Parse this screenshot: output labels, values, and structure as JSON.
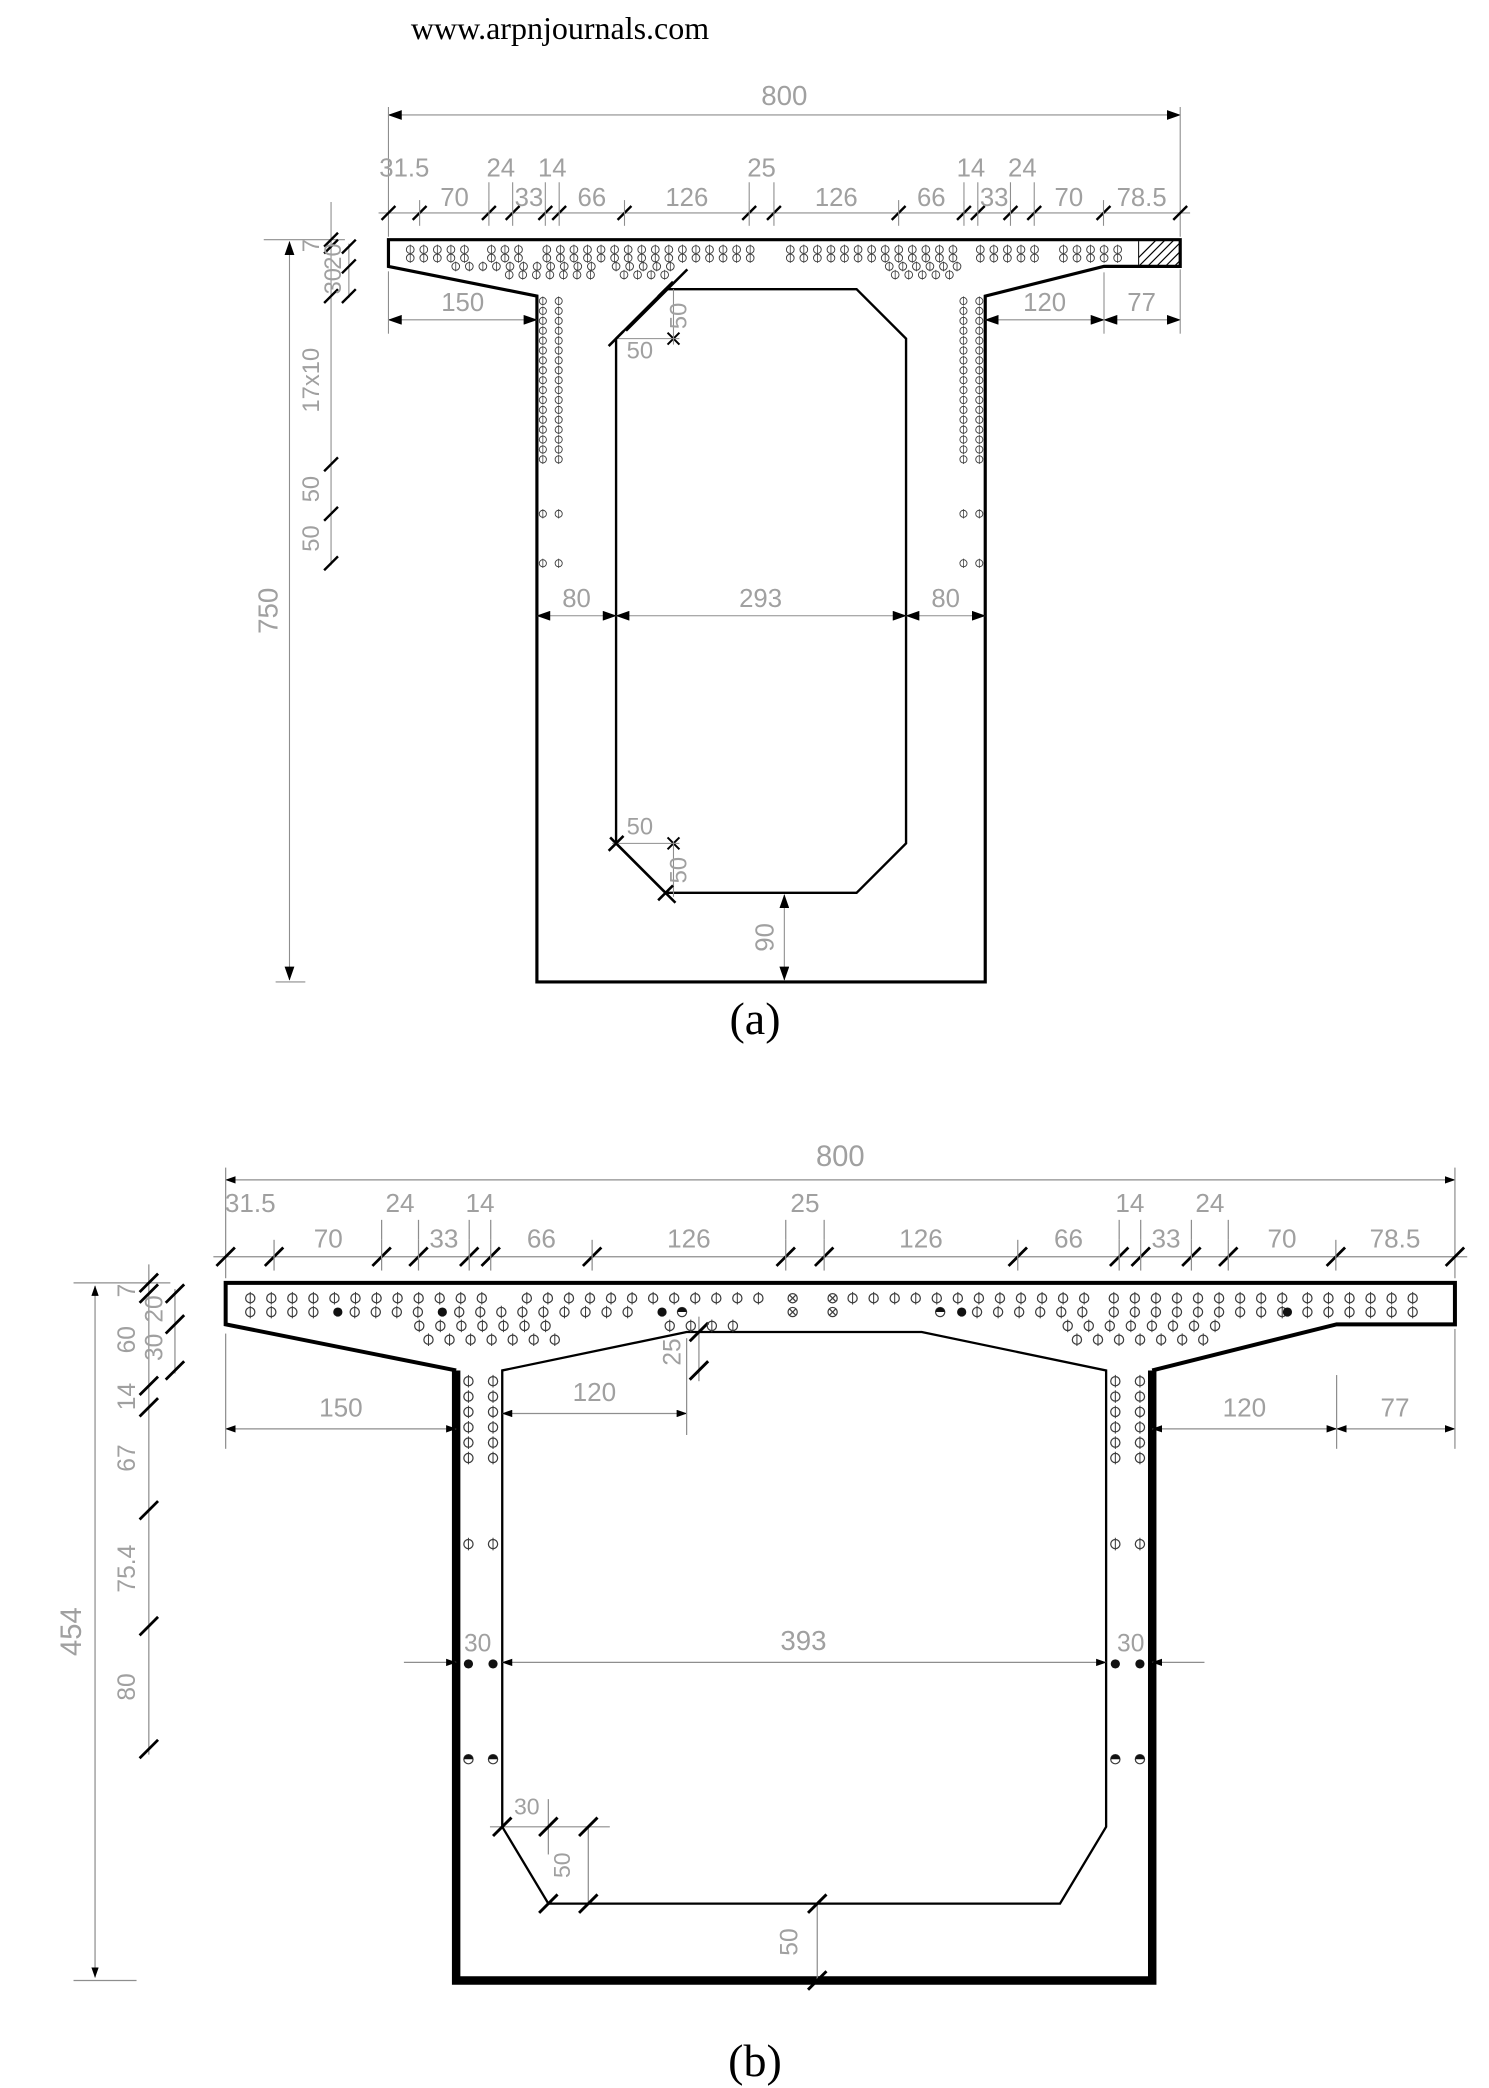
{
  "page": {
    "title": "www.arpnjournals.com"
  },
  "figure_a": {
    "caption": "(a)",
    "overall_width": "800",
    "overall_height": "750",
    "top_upper": [
      "31.5",
      "24",
      "14",
      "25",
      "14",
      "24"
    ],
    "top_lower": [
      "70",
      "33",
      "66",
      "126",
      "126",
      "66",
      "33",
      "70",
      "78.5"
    ],
    "left_chain": [
      "7",
      "20",
      "30",
      "17x10",
      "50",
      "50"
    ],
    "cantilever_left": "150",
    "taper_right": "120",
    "edge_right": "77",
    "web_left": "80",
    "void_width": "293",
    "web_right": "80",
    "chamfer_top": [
      "50",
      "50"
    ],
    "chamfer_bottom": [
      "50",
      "50"
    ],
    "bottom_slab": "90"
  },
  "figure_b": {
    "caption": "(b)",
    "overall_width": "800",
    "overall_height": "454",
    "top_upper": [
      "31.5",
      "24",
      "14",
      "25",
      "14",
      "24"
    ],
    "top_lower": [
      "70",
      "33",
      "66",
      "126",
      "126",
      "66",
      "33",
      "70",
      "78.5"
    ],
    "left_chain": [
      "7",
      "20",
      "30",
      "60",
      "14",
      "67",
      "75.4",
      "80"
    ],
    "cantilever_left": "150",
    "haunch_width": "120",
    "haunch_rise": "25",
    "taper_right": "120",
    "edge_right": "77",
    "web_left": "30",
    "void_width": "393",
    "web_right": "30",
    "chamfer_width": "30",
    "chamfer_height": "50",
    "bottom_slab": "50"
  }
}
